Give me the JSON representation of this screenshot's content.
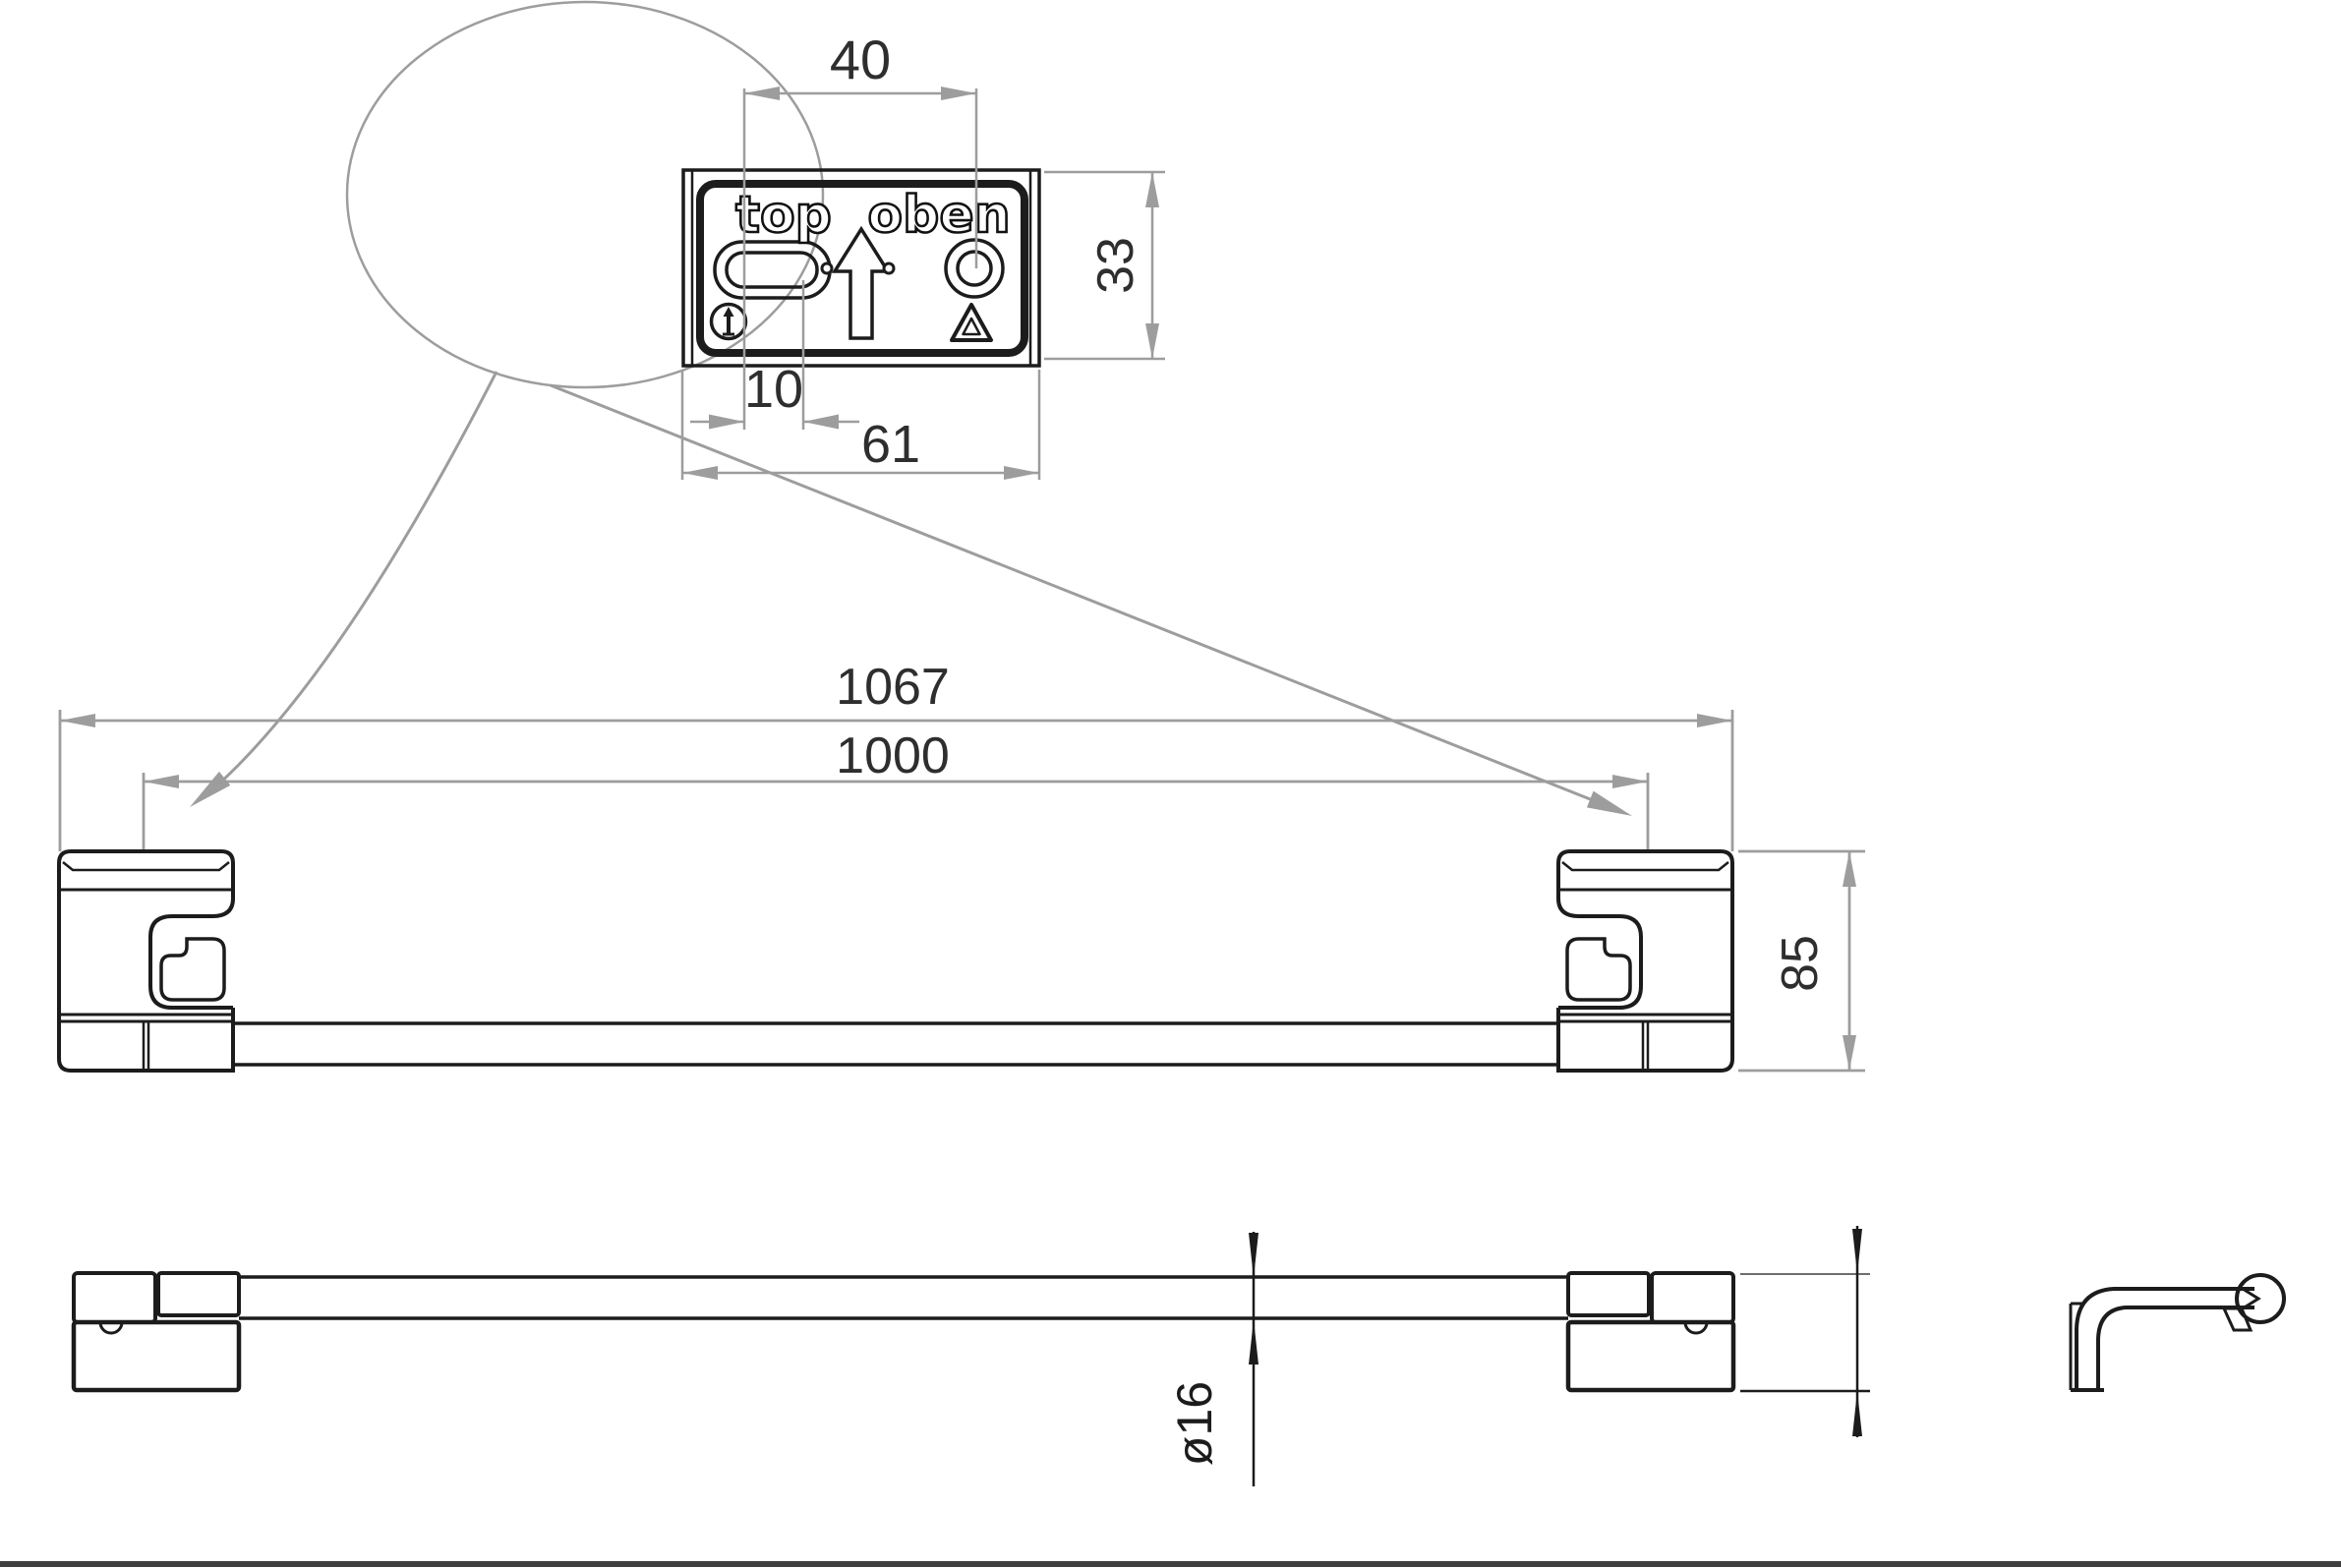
{
  "drawing": {
    "type": "technical-dimension-drawing",
    "product": "towel bar with wall brackets"
  },
  "detail_view": {
    "label_top": "top",
    "label_oben": "oben",
    "dim_slot_to_hole": "40",
    "dim_plate_height": "33",
    "dim_slot_length": "10",
    "dim_plate_width": "61",
    "icons": {
      "orientation_icon": "circled up arrow",
      "recycle_icon": "recycling triangle"
    }
  },
  "front_view": {
    "dim_overall_width": "1067",
    "dim_mounting_distance": "1000",
    "dim_bracket_height": "85"
  },
  "bottom_view": {
    "dim_bar_diameter": "ø16"
  },
  "colors": {
    "part_line": "#1c1c1c",
    "dimension_line": "#9d9d9d",
    "dimension_text": "#2e2e2e",
    "frame": "#3f3f3f"
  }
}
